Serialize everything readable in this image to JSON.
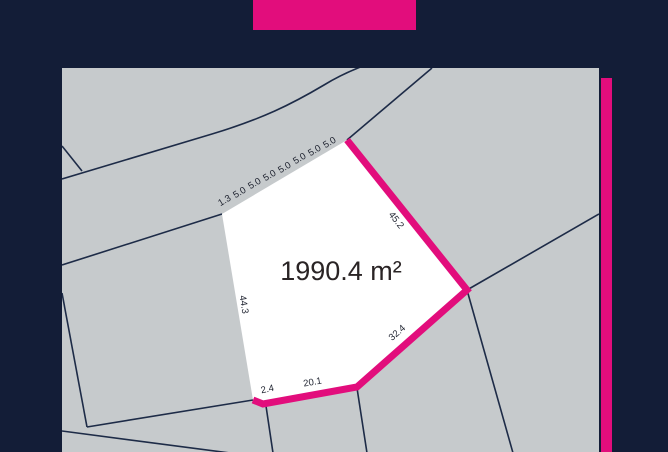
{
  "banner": {
    "title": "الجنبية"
  },
  "map": {
    "plot": {
      "area": "1990.4 m²",
      "top_segments": [
        "1.3",
        "5.0",
        "5.0",
        "5.0",
        "5.0",
        "5.0",
        "5.0",
        "5.0"
      ],
      "side_right": "45.2",
      "side_bottom_right": "32.4",
      "side_bottom": "20.1",
      "side_bottom_left": "2.4",
      "side_left": "44.3"
    }
  },
  "colors": {
    "background_navy": "#131d37",
    "accent_pink": "#e20d7c",
    "map_gray": "#c6cacc",
    "parcel_line_navy": "#1d2b47",
    "plot_white": "#ffffff",
    "label_dark": "#1f2330"
  }
}
